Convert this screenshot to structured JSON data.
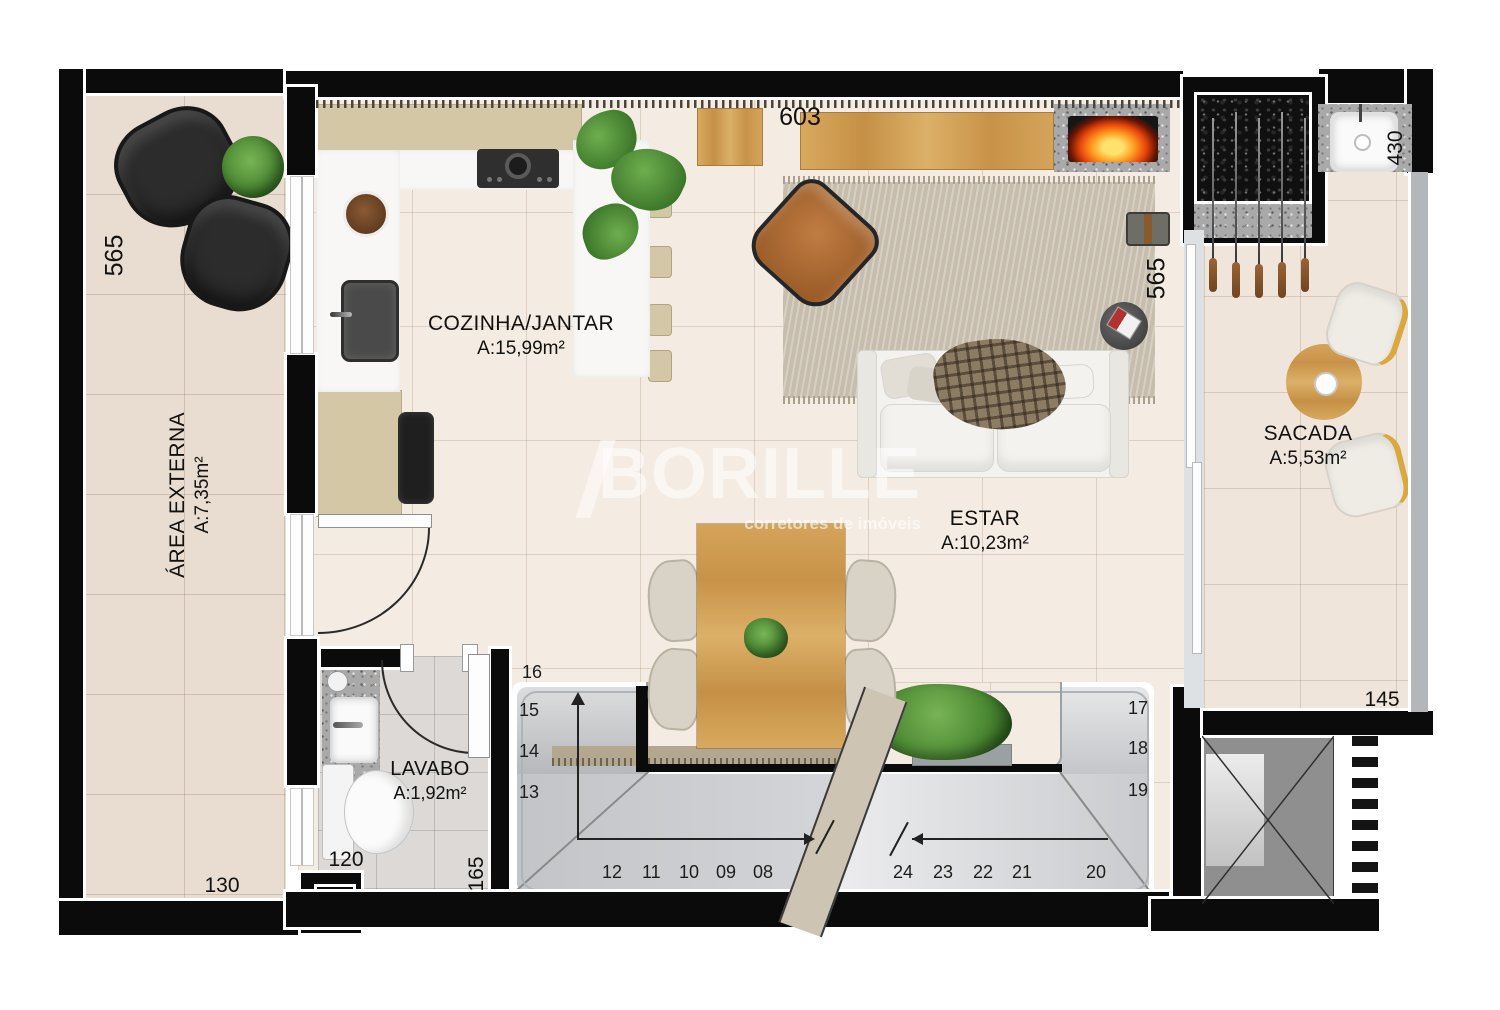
{
  "brand": {
    "name": "BORILLE",
    "tagline": "corretores de imóveis"
  },
  "rooms": {
    "kitchen": {
      "label": "COZINHA/JANTAR",
      "area": "A:15,99m²"
    },
    "living": {
      "label": "ESTAR",
      "area": "A:10,23m²"
    },
    "balcony": {
      "label": "SACADA",
      "area": "A:5,53m²"
    },
    "bathroom": {
      "label": "LAVABO",
      "area": "A:1,92m²"
    },
    "outdoor": {
      "label": "ÁREA EXTERNA",
      "area": "A:7,35m²"
    }
  },
  "dims": {
    "kitchen_top": "603",
    "outdoor_left": "565",
    "living_right": "565",
    "balcony_sink": "430",
    "balcony_bottom": "145",
    "outdoor_bottom": "130",
    "bathroom_width": "120",
    "bathroom_length": "165"
  },
  "stairs": {
    "upper_left": [
      "16",
      "15",
      "14",
      "13"
    ],
    "lower_left": [
      "12",
      "11",
      "10",
      "09",
      "08"
    ],
    "lower_right": [
      "24",
      "23",
      "22",
      "21",
      "20"
    ],
    "upper_right": [
      "17",
      "18",
      "19"
    ]
  },
  "colors": {
    "wall": "#0b0b0b",
    "floor": "#f4ebe2",
    "outdoor_floor": "#e9ddd1",
    "balcony_floor": "#f0e5da",
    "bathroom_floor": "#dcd9d6",
    "wood": "#cd9c55",
    "cabinet": "#d3c7a6",
    "counter": "#f8f7f5",
    "stair": "#c6c8ca",
    "rug": "#c6bdac",
    "fire": "#ff8a00",
    "plant": "#4e8a38",
    "leather": "#b06f38",
    "watermark": "#ffffff"
  }
}
